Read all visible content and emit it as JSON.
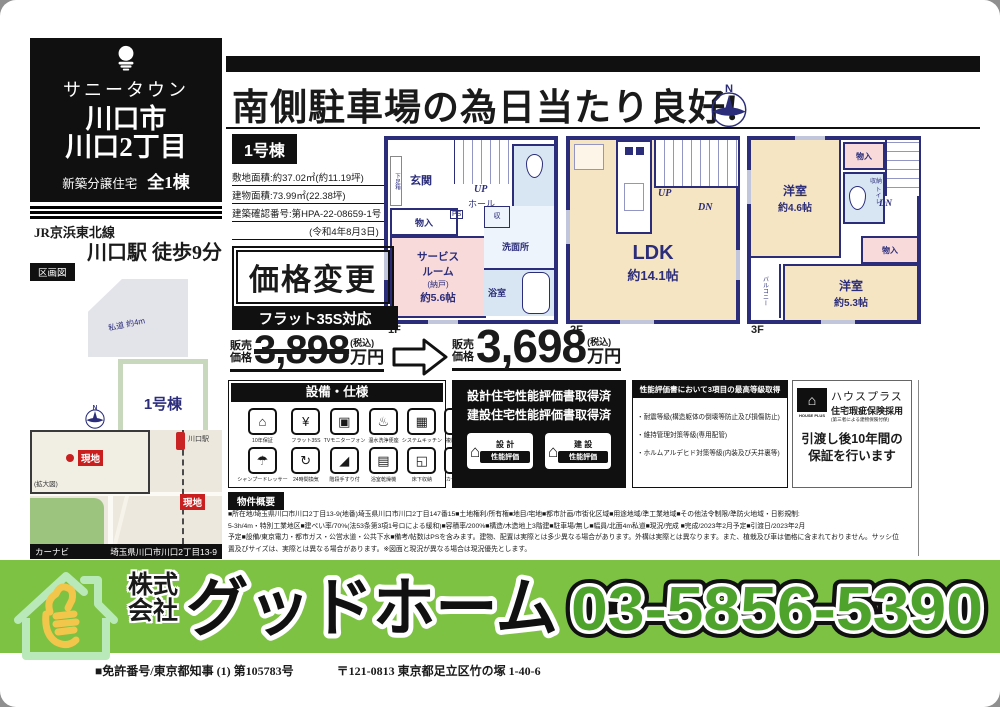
{
  "brand": {
    "project": "サニータウン",
    "city": "川口市",
    "district": "川口2丁目",
    "property_type": "新築分譲住宅",
    "total_units": "全1棟",
    "rail_line": "JR京浜東北線",
    "station_access": "川口駅 徒歩9分"
  },
  "plot": {
    "section_label": "区画図",
    "private_road": "私道 約4m",
    "lot_name": "1号棟",
    "compass_n": "N"
  },
  "map": {
    "inset_label": "(拡大図)",
    "marker1": "現地",
    "marker2": "現地",
    "station": "川口駅",
    "navi_label": "カーナビ",
    "navi_address": "埼玉県川口市川口2丁目13-9"
  },
  "main": {
    "headline": "南側駐車場の為日当たり良好!",
    "unit_label": "1号棟",
    "spec1": "敷地面積:約37.02㎡(約11.19坪)",
    "spec2": "建物面積:73.99㎡(22.38坪)",
    "spec3": "建築確認番号:第HPA-22-08659-1号",
    "spec4": "(令和4年8月3日)"
  },
  "floors": {
    "f1": {
      "label": "1F",
      "genkan": "玄関",
      "getabako": "下足箱",
      "up": "UP",
      "hall": "ホール",
      "ps": "PS",
      "monoire": "物入",
      "service1": "サービス",
      "service2": "ルーム",
      "service3": "(納戸)",
      "service4": "約5.6帖",
      "shu": "収",
      "senmenjo": "洗面所",
      "bath": "浴室"
    },
    "f2": {
      "label": "2F",
      "up": "UP",
      "dn": "DN",
      "ldk": "LDK",
      "ldk_size": "約14.1帖"
    },
    "f3": {
      "label": "3F",
      "room1": "洋室",
      "room1_size": "約4.6帖",
      "monoire1": "物入",
      "shunou": "収納",
      "toilet": "トイレ",
      "dn": "DN",
      "monoire2": "物入",
      "room2": "洋室",
      "room2_size": "約5.3帖",
      "balcony": "バルコニー"
    }
  },
  "price": {
    "change_badge": "価格変更",
    "flat35": "フラット35S対応",
    "label1": "販売",
    "label2": "価格",
    "old_amount": "3,898",
    "new_amount": "3,698",
    "tax": "(税込)",
    "unit": "万円"
  },
  "equipment": {
    "title": "設備・仕様",
    "items": [
      {
        "label": "10年保証",
        "glyph": "⌂"
      },
      {
        "label": "フラット35S",
        "glyph": "¥"
      },
      {
        "label": "TVモニターフォン",
        "glyph": "▣"
      },
      {
        "label": "温水洗浄便座",
        "glyph": "♨"
      },
      {
        "label": "システムキッチン",
        "glyph": "▦"
      },
      {
        "label": "複層ガラス",
        "glyph": "▨"
      },
      {
        "label": "シャンプードレッサー",
        "glyph": "☂"
      },
      {
        "label": "24時間換気",
        "glyph": "↻"
      },
      {
        "label": "階段手すり付",
        "glyph": "◢"
      },
      {
        "label": "浴室乾燥機",
        "glyph": "▤"
      },
      {
        "label": "床下収納",
        "glyph": "◱"
      },
      {
        "label": "カードキー",
        "glyph": "⊟"
      }
    ]
  },
  "certification": {
    "line1": "設計住宅性能評価書取得済",
    "line2": "建設住宅性能評価書取得済",
    "badge1_house": "⌂",
    "badge1_top": "設 計",
    "badge1_bottom": "性能評価",
    "badge2_house": "⌂",
    "badge2_top": "建 設",
    "badge2_bottom": "性能評価"
  },
  "grades": {
    "title": "性能評価書において3項目の最高等級取得",
    "item1": "・耐震等級(構造躯体の倒壊等防止及び損傷防止)",
    "item2": "・維持管理対策等級(専用配管)",
    "item3": "・ホルムアルデヒド対策等級(内装及び天井裏等)"
  },
  "warranty": {
    "logo_glyph": "⌂",
    "logo_text": "HOUSE PLUS",
    "name_line1": "ハウスプラス",
    "name_line2": "住宅瑕疵保険採用",
    "name_note": "(第三者による建物保険付保)",
    "desc_line1": "引渡し後10年間の",
    "desc_line2": "保証を行います"
  },
  "overview": {
    "title": "物件概要",
    "line1": "■所在地/埼玉県川口市川口2丁目13-9(地番)埼玉県川口市川口2丁目147番15■土地権利/所有権■地目/宅地■都市計画/市街化区域■用途地域/準工業地域■その他法令制限/準防火地域・日影規制:",
    "line2": "5-3h/4m・特別工業地区■建ぺい率/70%(法53条第3項1号ロによる緩和)■容積率/200%■構造/木造地上3階建■駐車場/無し■幅員/北面4m私道■現況/完成 ■完成/2023年2月予定■引渡日/2023年2月",
    "line3": "予定■設備/東京電力・都市ガス・公営水道・公共下水■備考/帖数はPSを含みます。建物、配置は実際とは多少異なる場合があります。外構は実際とは異なります。また、植栽及び車は価格に含まれておりません。サッシ位",
    "line4": "置及びサイズは、実際とは異なる場合があります。※図面と現況が異なる場合は現況優先とします。"
  },
  "footer": {
    "company_line1": "株式",
    "company_line2": "会社",
    "company_name": "グッドホーム",
    "phone": "03-5856-5390",
    "license": "■免許番号/東京都知事 (1) 第105783号",
    "address": "〒121-0813 東京都足立区竹の塚 1-40-6",
    "green": "#7dc243",
    "phone_color": "#4ea32d"
  }
}
